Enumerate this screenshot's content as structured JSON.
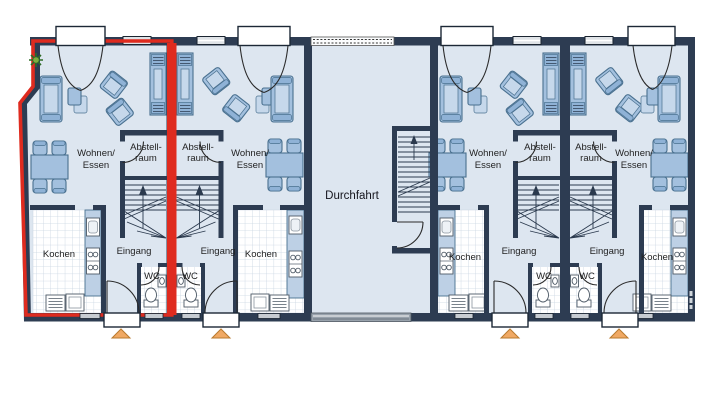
{
  "floor_plan": {
    "type": "row-house ground floor plan",
    "passage": {
      "label": "Durchfahrt"
    },
    "room_labels": {
      "living_line1": "Wohnen/",
      "living_line2": "Essen",
      "storage_line1": "Abstell-",
      "storage_line2": "raum",
      "kitchen": "Kochen",
      "entrance": "Eingang",
      "wc": "WC"
    },
    "units": [
      {
        "id": 1,
        "highlighted": true
      },
      {
        "id": 2,
        "highlighted": false
      },
      {
        "id": 3,
        "highlighted": false
      },
      {
        "id": 4,
        "highlighted": false
      }
    ],
    "colors": {
      "wall": "#2d3c52",
      "room_fill": "#dde6f0",
      "furniture": "#a3c0de",
      "highlight_outline": "#df2b1f",
      "entrance_marker": "#f0a964",
      "window": "#dfe3e7",
      "gate": "#98a2ac"
    }
  }
}
